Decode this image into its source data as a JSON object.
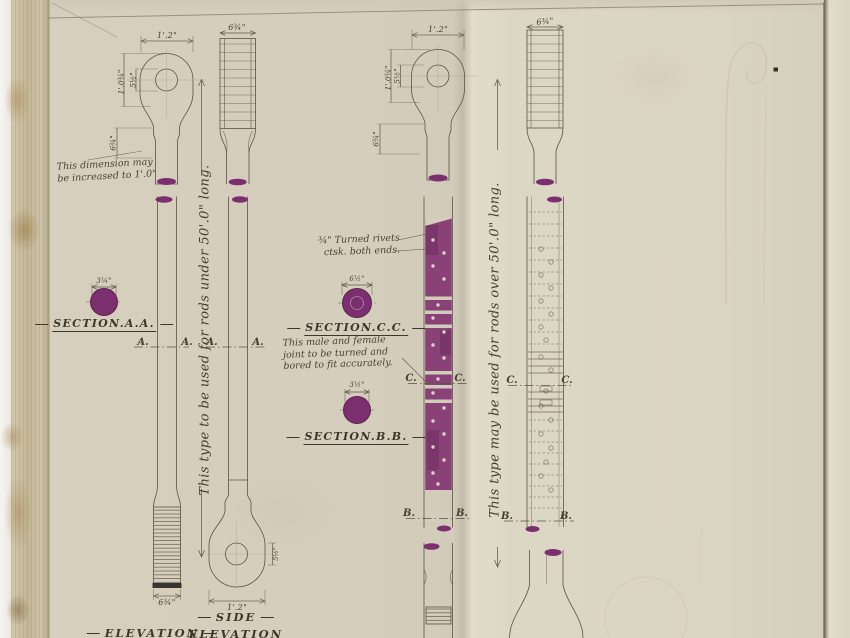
{
  "colors": {
    "purple": "#7c2f6e",
    "joint_purple": "#8a4178",
    "ink": "#5b5447",
    "paper": "#d6cfbd"
  },
  "notes": {
    "dimension_note_1": "This dimension may",
    "dimension_note_2": "be increased to 1'.0\"",
    "rivets_note_1": "¾\" Turned rivets",
    "rivets_note_2": "ctsk. both ends.",
    "joint_note_1": "This male and female",
    "joint_note_2": "joint to be turned and",
    "joint_note_3": "bored to fit accurately.",
    "type_note_left": "This type to be used for rods under 50'.0\" long.",
    "type_note_right": "This type may be used for rods over 50'.0\" long."
  },
  "sections": {
    "aa": {
      "label": "SECTION.A.A.",
      "dim": "3¼\""
    },
    "cc": {
      "label": "SECTION.C.C.",
      "dim": "6½\""
    },
    "bb": {
      "label": "SECTION.B.B.",
      "dim": "3½\""
    }
  },
  "views": {
    "elevation": "ELEVATION",
    "side_1": "SIDE",
    "side_2": "ELEVATION"
  },
  "markers": {
    "a": "A.",
    "b": "B.",
    "c": "C."
  },
  "dims": {
    "rod1_top": "1'.2\"",
    "rod1_hole": "5½\"",
    "rod1_head": "1'.0¾\"",
    "rod1_neck": "6¾\"",
    "rod2_top": "6¾\"",
    "rod1_end": "6¾\"",
    "rod2_end": "1'.2\"",
    "rod2_hole": "5½\"",
    "rod3_top": "1'.2\"",
    "rod3_hole": "5½\"",
    "rod3_head": "1'.0¾\"",
    "rod3_neck": "6¾\"",
    "rod4_top": "6¾\""
  }
}
